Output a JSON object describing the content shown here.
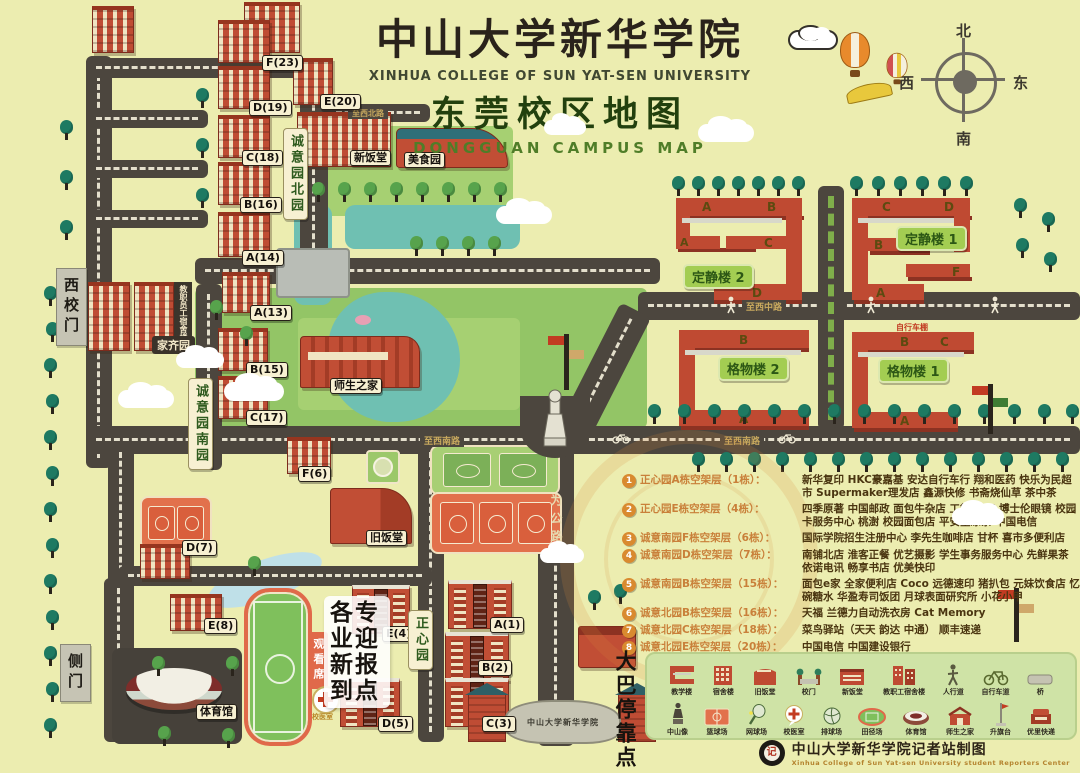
{
  "title": {
    "cn": "中山大学新华学院",
    "en": "XINHUA  COLLEGE  OF  SUN YAT-SEN  UNIVERSITY",
    "cn2": "东莞校区地图",
    "en2": "DONGGUAN   CAMPUS   MAP"
  },
  "compass": {
    "n": "北",
    "s": "南",
    "e": "东",
    "w": "西"
  },
  "gates": {
    "west": "西校门",
    "side": "侧门",
    "main": "中山大学新华学院"
  },
  "areas": {
    "north_garden": "诚意园北园",
    "south_garden": "诚意园南园",
    "jiaqi": "家齐园",
    "zhengxin": "正心园",
    "staff_dorm": "教职员工宿舍楼"
  },
  "roads": {
    "north": "至西北路",
    "middle": "至西中路",
    "south": "至西南路",
    "south2": "至西南路",
    "weigong": "为公路"
  },
  "facilities": {
    "new_canteen": "新饭堂",
    "food_court": "美食园",
    "teacher_student_home": "师生之家",
    "old_canteen": "旧饭堂",
    "gym": "体育馆",
    "stands": "观看席",
    "clinic": "校医室",
    "bike_shed": "自行车棚",
    "registration": "各专业迎新报到点",
    "bus_stop": "大巴停靠点"
  },
  "buildings": {
    "f23": "F(23)",
    "d19": "D(19)",
    "e20": "E(20)",
    "c18": "C(18)",
    "b16": "B(16)",
    "a14": "A(14)",
    "a13": "A(13)",
    "b15": "B(15)",
    "c17": "C(17)",
    "f6": "F(6)",
    "d7": "D(7)",
    "e8": "E(8)",
    "a1": "A(1)",
    "e4": "E(4)",
    "b2": "B(2)",
    "d5": "D(5)",
    "c3": "C(3)"
  },
  "teaching": {
    "dj2": {
      "name": "定静楼 2",
      "wings": [
        "A",
        "B",
        "A",
        "C",
        "D"
      ]
    },
    "dj1": {
      "name": "定静楼 1",
      "wings": [
        "C",
        "D",
        "B",
        "E",
        "F",
        "A"
      ]
    },
    "gw2": {
      "name": "格物楼 2",
      "wings": [
        "B",
        "A"
      ]
    },
    "gw1": {
      "name": "格物楼 1",
      "wings": [
        "B",
        "C",
        "A"
      ]
    }
  },
  "legend_list": [
    {
      "num": "1",
      "name": "正心园A栋空架层（1栋）：",
      "shops": "新华复印 HKC豪嘉基 安达自行车行 翔和医药 快乐为民超市 Supermaker理发店 鑫源快修 书斋烧仙草 茶中茶"
    },
    {
      "num": "2",
      "name": "正心园E栋空架层（4栋）：",
      "shops": "四季原著 中国邮政 面包牛杂店 工行ATM 博士伦眼镜 校园卡服务中心 桃澍 校园面包店 平安堂凉茶 中国电信"
    },
    {
      "num": "3",
      "name": "诚意南园F栋空架层（6栋）：",
      "shops": "国际学院招生注册中心 李先生咖啡店 甘杯 喜市多便利店"
    },
    {
      "num": "4",
      "name": "诚意南园D栋空架层（7栋）：",
      "shops": "南铺北店 淮客正餐 优艺摄影 学生事务服务中心 先鲜果茶 依诺电讯 畅享书店 优美快印"
    },
    {
      "num": "5",
      "name": "诚意南园B栋空架层（15栋）：",
      "shops": "面包e家 全家便利店 Coco 远德速印 猪扒包 元妹饮食店 忆碗糖水 华盈寿司饭团 月球表面研究所 小花小甲"
    },
    {
      "num": "6",
      "name": "诚意北园B栋空架层（16栋）：",
      "shops": "天福 兰德力自动洗衣房 Cat Memory"
    },
    {
      "num": "7",
      "name": "诚意北园C栋空架层（18栋）：",
      "shops": "菜鸟驿站（天天 韵达 中通） 顺丰速递"
    },
    {
      "num": "8",
      "name": "诚意北园E栋空架层（20栋）：",
      "shops": "中国电信 中国建设银行"
    }
  ],
  "legend_icons": {
    "row1": [
      {
        "icon": "teach",
        "label": "教学楼"
      },
      {
        "icon": "dorm",
        "label": "宿舍楼"
      },
      {
        "icon": "oldcanteen",
        "label": "旧饭堂"
      },
      {
        "icon": "gate",
        "label": "校门"
      },
      {
        "icon": "newcanteen",
        "label": "新饭堂"
      },
      {
        "icon": "staffdorm",
        "label": "教职工宿舍楼"
      },
      {
        "icon": "walk",
        "label": "人行道"
      },
      {
        "icon": "bike",
        "label": "自行车道"
      },
      {
        "icon": "bridge",
        "label": "桥"
      }
    ],
    "row2": [
      {
        "icon": "statue",
        "label": "中山像"
      },
      {
        "icon": "bball",
        "label": "篮球场"
      },
      {
        "icon": "tennis",
        "label": "网球场"
      },
      {
        "icon": "clinic",
        "label": "校医室"
      },
      {
        "icon": "vball",
        "label": "排球场"
      },
      {
        "icon": "track",
        "label": "田径场"
      },
      {
        "icon": "stadium",
        "label": "体育馆"
      },
      {
        "icon": "home",
        "label": "师生之家"
      },
      {
        "icon": "flagpole",
        "label": "升旗台"
      },
      {
        "icon": "express",
        "label": "优里快递"
      }
    ]
  },
  "credit": {
    "text": "中山大学新华学院记者站制图",
    "sub": "Xinhua College of Sun Yat-sen University student Reporters Center"
  }
}
